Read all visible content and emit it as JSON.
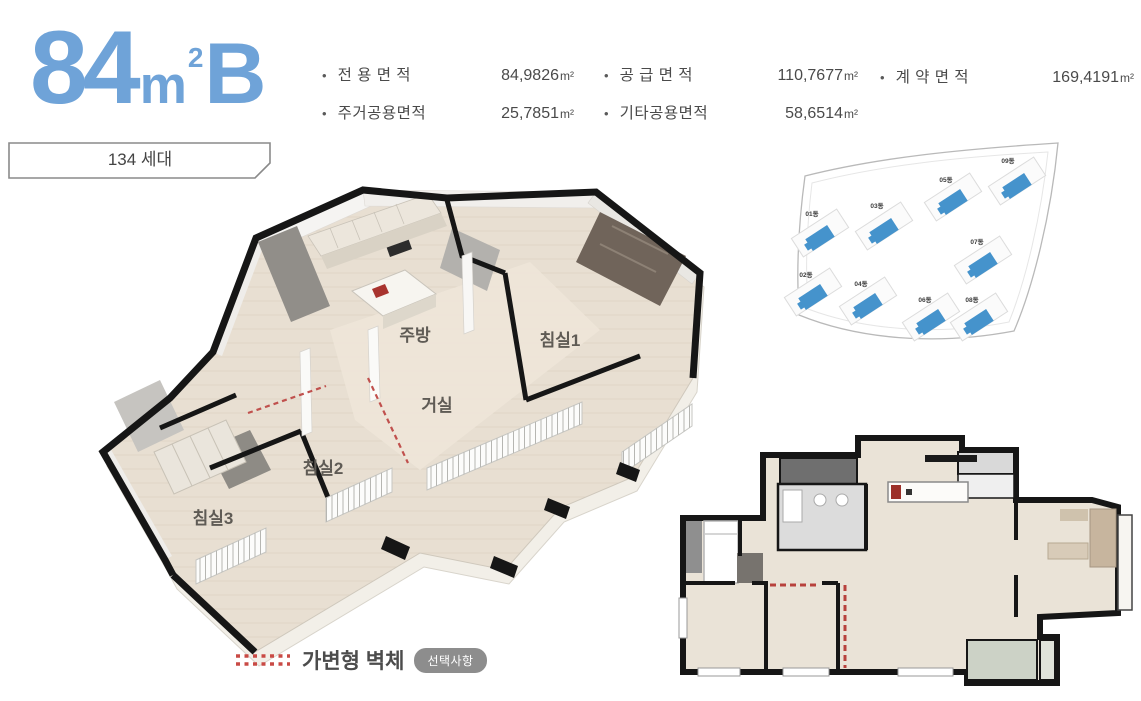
{
  "header": {
    "size": "84",
    "unit": "m",
    "sup": "2",
    "variant": "B",
    "households": "134 세대"
  },
  "specs": {
    "row1": [
      {
        "label": "전 용 면 적",
        "value": "84,9826",
        "unit": "m²"
      },
      {
        "label": "공 급 면 적",
        "value": "110,7677",
        "unit": "m²"
      },
      {
        "label": "계 약 면 적",
        "value": "169,4191",
        "unit": "m²"
      }
    ],
    "row2": [
      {
        "label": "주거공용면적",
        "value": "25,7851",
        "unit": "m²"
      },
      {
        "label": "기타공용면적",
        "value": "58,6514",
        "unit": "m²"
      }
    ]
  },
  "plan3d": {
    "rooms": [
      {
        "name": "주방"
      },
      {
        "name": "침실1"
      },
      {
        "name": "거실"
      },
      {
        "name": "침실2"
      },
      {
        "name": "침실3"
      }
    ]
  },
  "siteplan": {
    "buildings": [
      {
        "label": "01동"
      },
      {
        "label": "02동"
      },
      {
        "label": "03동"
      },
      {
        "label": "04동"
      },
      {
        "label": "05동"
      },
      {
        "label": "06동"
      },
      {
        "label": "07동"
      },
      {
        "label": "08동"
      },
      {
        "label": "09동"
      }
    ]
  },
  "legend": {
    "label": "가변형 벽체",
    "badge": "선택사항"
  },
  "colors": {
    "accent_blue": "#6fa3d8",
    "building_blue": "#4593cc",
    "dash_red": "#c0504d",
    "badge_gray": "#8d8d8d",
    "text_dark": "#4a4a4a"
  }
}
